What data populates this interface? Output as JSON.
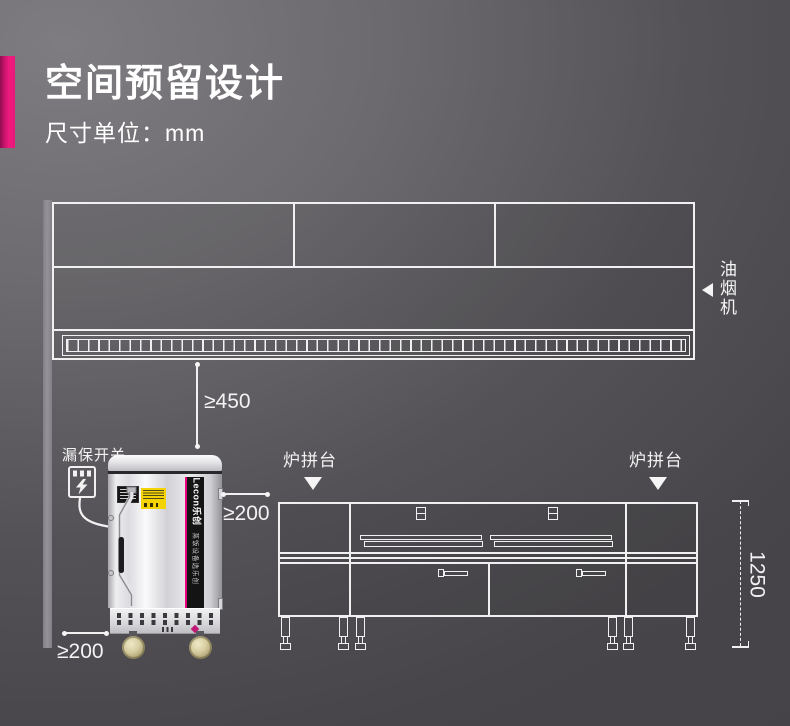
{
  "header": {
    "title": "空间预留设计",
    "subtitle": "尺寸单位：mm"
  },
  "hood": {
    "label": "油烟机"
  },
  "breaker": {
    "label": "漏保开关"
  },
  "cabinet": {
    "brand": "Lecon乐创",
    "slogan": "蒸饭设备选乐创"
  },
  "counter": {
    "left_platform_label": "炉拼台",
    "right_platform_label": "炉拼台"
  },
  "dimensions": {
    "hood_to_cabinet": "≥450",
    "cabinet_to_counter": "≥200",
    "wall_to_cabinet": "≥200",
    "counter_height": "1250"
  },
  "colors": {
    "accent_pink": "#E9187A",
    "brand_magenta": "#E6007E",
    "line": "#F2F2F2",
    "background_top": "#7B797D",
    "background_bottom": "#454347"
  },
  "icons": {
    "hood_pointer": "left-triangle",
    "platform_pointer": "down-triangle",
    "breaker_box": "leakage-breaker-with-lightning"
  }
}
